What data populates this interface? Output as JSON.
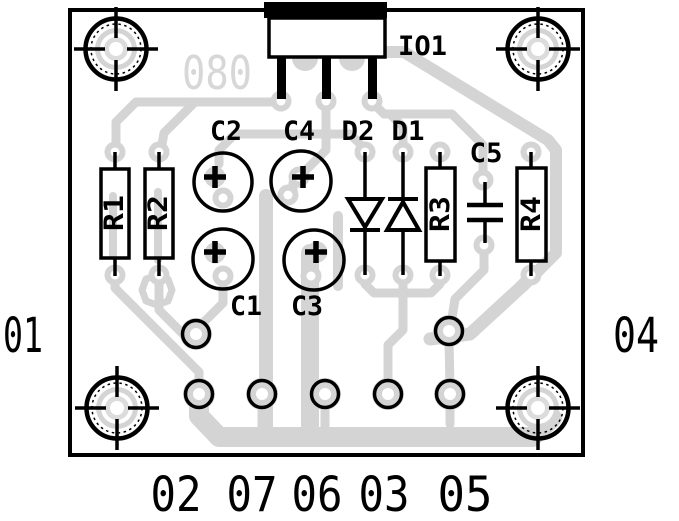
{
  "diagram": {
    "type": "pcb-component-layout",
    "board_id": "080",
    "components": {
      "io1": "IO1",
      "r1": "R1",
      "r2": "R2",
      "r3": "R3",
      "r4": "R4",
      "c1": "C1",
      "c2": "C2",
      "c3": "C3",
      "c4": "C4",
      "c5": "C5",
      "d1": "D1",
      "d2": "D2"
    },
    "pins": {
      "left": "01",
      "right": "04",
      "bottom": [
        "02",
        "07",
        "06",
        "03",
        "05"
      ]
    },
    "colors": {
      "copper": "#d4d4d4",
      "silkscreen": "#000000",
      "background": "#ffffff"
    }
  }
}
